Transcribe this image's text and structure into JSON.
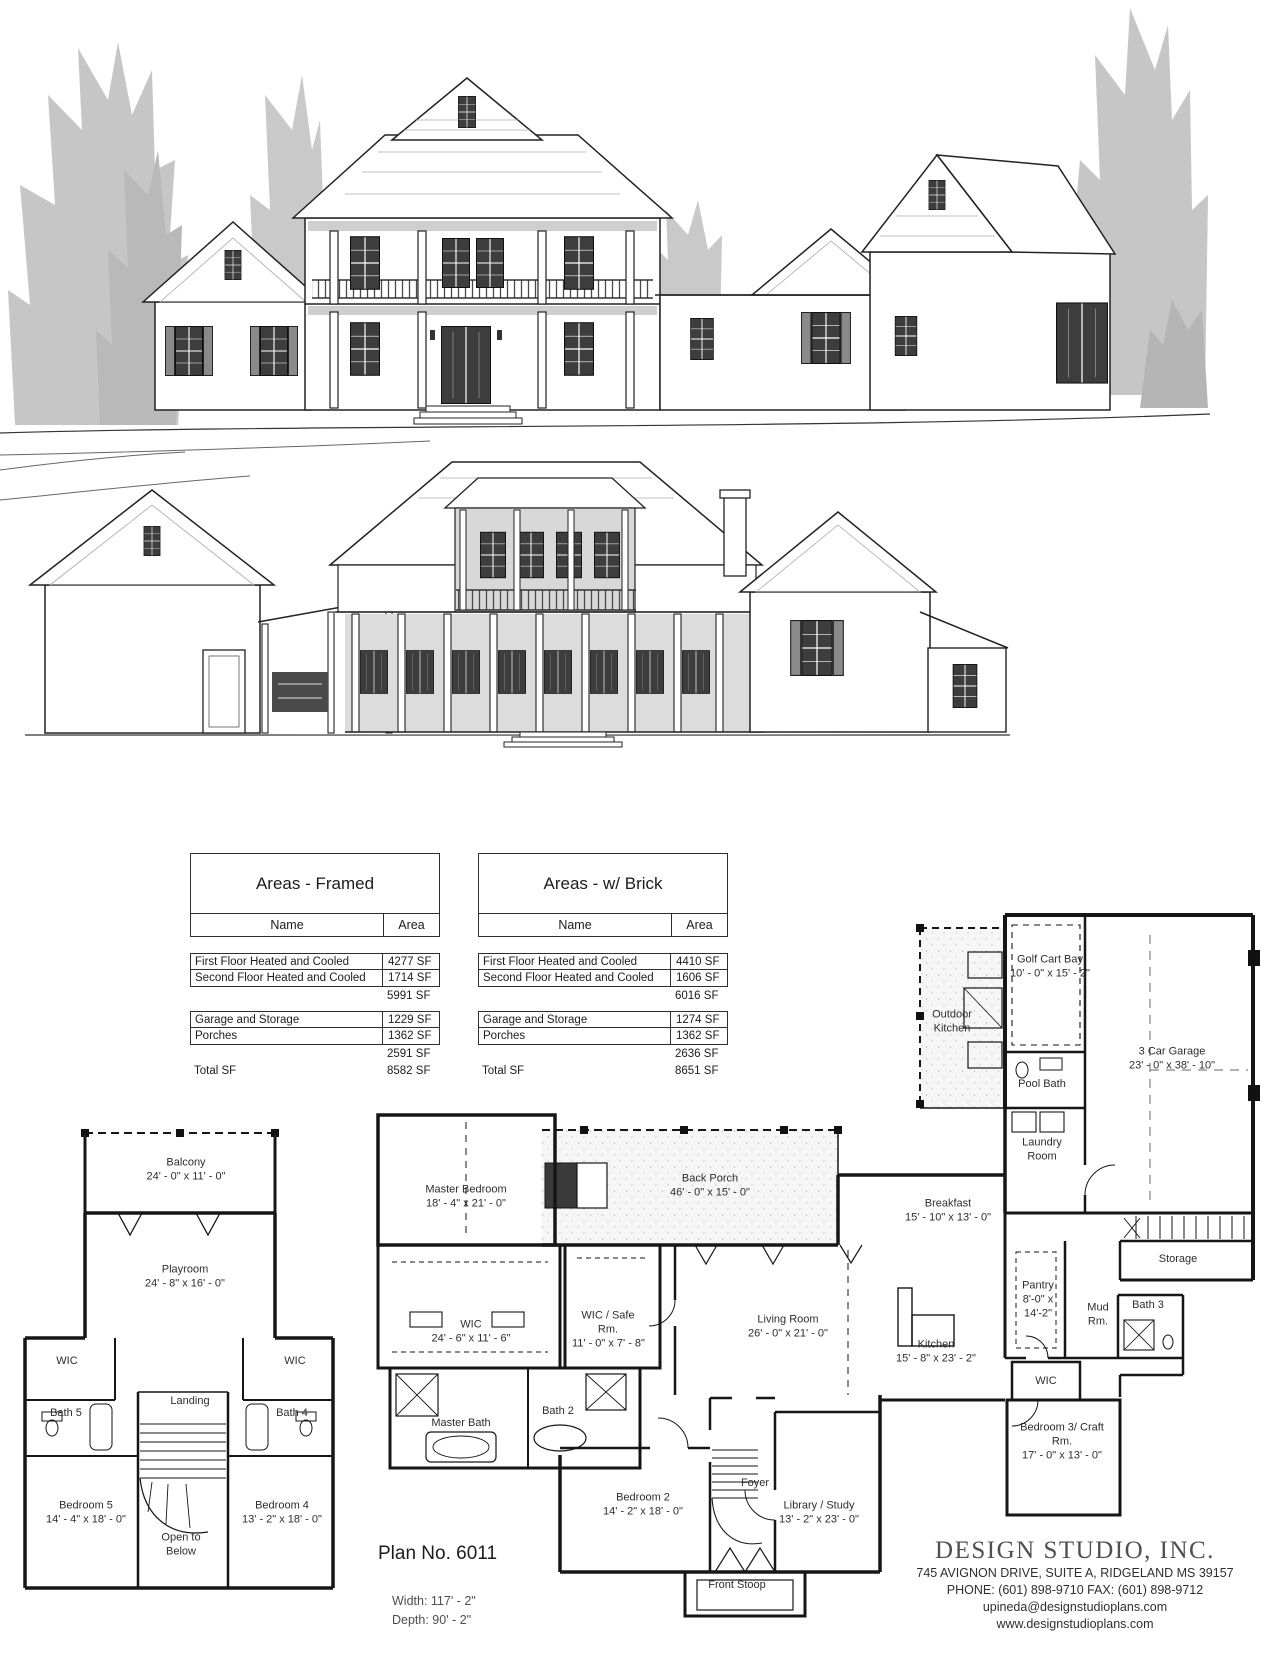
{
  "sheet": {
    "plan_no": "Plan No. 6011",
    "width": "Width: 117' - 2\"",
    "depth": "Depth: 90' - 2\""
  },
  "tables": {
    "framed": {
      "title": "Areas - Framed",
      "col_name": "Name",
      "col_area": "Area",
      "rows": [
        {
          "name": "First Floor Heated and Cooled",
          "area": "4277 SF"
        },
        {
          "name": "Second Floor Heated and Cooled",
          "area": "1714 SF"
        },
        {
          "name": "",
          "area": "5991 SF"
        },
        {
          "name": "Garage and Storage",
          "area": "1229 SF"
        },
        {
          "name": "Porches",
          "area": "1362 SF"
        },
        {
          "name": "",
          "area": "2591 SF"
        },
        {
          "name": "Total SF",
          "area": "8582 SF"
        }
      ]
    },
    "brick": {
      "title": "Areas - w/ Brick",
      "col_name": "Name",
      "col_area": "Area",
      "rows": [
        {
          "name": "First Floor Heated and Cooled",
          "area": "4410 SF"
        },
        {
          "name": "Second Floor Heated and Cooled",
          "area": "1606 SF"
        },
        {
          "name": "",
          "area": "6016 SF"
        },
        {
          "name": "Garage and Storage",
          "area": "1274 SF"
        },
        {
          "name": "Porches",
          "area": "1362 SF"
        },
        {
          "name": "",
          "area": "2636 SF"
        },
        {
          "name": "Total SF",
          "area": "8651 SF"
        }
      ]
    }
  },
  "second_floor": {
    "balcony": {
      "name": "Balcony",
      "dims": "24' - 0\" x 11' - 0\""
    },
    "playroom": {
      "name": "Playroom",
      "dims": "24' - 8\" x 16' - 0\""
    },
    "wic_left": {
      "name": "WIC"
    },
    "wic_right": {
      "name": "WIC"
    },
    "bath5": {
      "name": "Bath 5"
    },
    "bath4": {
      "name": "Bath 4"
    },
    "landing": {
      "name": "Landing"
    },
    "bedroom5": {
      "name": "Bedroom 5",
      "dims": "14' - 4\" x 18' - 0\""
    },
    "bedroom4": {
      "name": "Bedroom 4",
      "dims": "13' - 2\" x 18' - 0\""
    },
    "open_below": {
      "name": "Open to Below"
    }
  },
  "first_floor": {
    "master_bedroom": {
      "name": "Master Bedroom",
      "dims": "18' - 4\" x 21' - 0\""
    },
    "back_porch": {
      "name": "Back Porch",
      "dims": "46' - 0\" x 15' - 0\""
    },
    "wic_master": {
      "name": "WIC",
      "dims": "24' - 6\" x 11' - 6\""
    },
    "safe_room": {
      "name": "WIC / Safe Rm.",
      "dims": "11' - 0\" x 7' - 8\""
    },
    "master_bath": {
      "name": "Master Bath"
    },
    "bath2": {
      "name": "Bath 2"
    },
    "bedroom2": {
      "name": "Bedroom 2",
      "dims": "14' - 2\" x 18' - 0\""
    },
    "foyer": {
      "name": "Foyer"
    },
    "living_room": {
      "name": "Living Room",
      "dims": "26' - 0\" x 21' - 0\""
    },
    "library": {
      "name": "Library / Study",
      "dims": "13' - 2\" x 23' - 0\""
    },
    "front_stoop": {
      "name": "Front Stoop"
    },
    "kitchen": {
      "name": "Kitchen",
      "dims": "15' - 8\" x 23' - 2\""
    },
    "breakfast": {
      "name": "Breakfast",
      "dims": "15' - 10\" x 13' - 0\""
    },
    "pantry": {
      "name": "Pantry",
      "dims": "8'-0\" x 14'-2\""
    },
    "mud_room": {
      "name": "Mud Rm."
    },
    "bath3": {
      "name": "Bath 3"
    },
    "wic_back": {
      "name": "WIC"
    },
    "bedroom3": {
      "name": "Bedroom 3/ Craft Rm.",
      "dims": "17' - 0\" x 13' - 0\""
    },
    "laundry": {
      "name": "Laundry Room"
    },
    "pool_bath": {
      "name": "Pool Bath"
    },
    "outdoor_kitchen": {
      "name": "Outdoor Kitchen"
    },
    "golf_cart_bay": {
      "name": "Golf Cart Bay",
      "dims": "10' - 0\" x 15' - 2\""
    },
    "garage": {
      "name": "3 Car Garage",
      "dims": "23' - 0\" x 38' - 10\""
    },
    "storage": {
      "name": "Storage"
    }
  },
  "footer": {
    "company": "DESIGN STUDIO, INC.",
    "address": "745 AVIGNON DRIVE, SUITE A, RIDGELAND MS 39157",
    "phone_fax": "PHONE: (601) 898-9710  FAX: (601) 898-9712",
    "email": "upineda@designstudioplans.com",
    "website": "www.designstudioplans.com"
  }
}
